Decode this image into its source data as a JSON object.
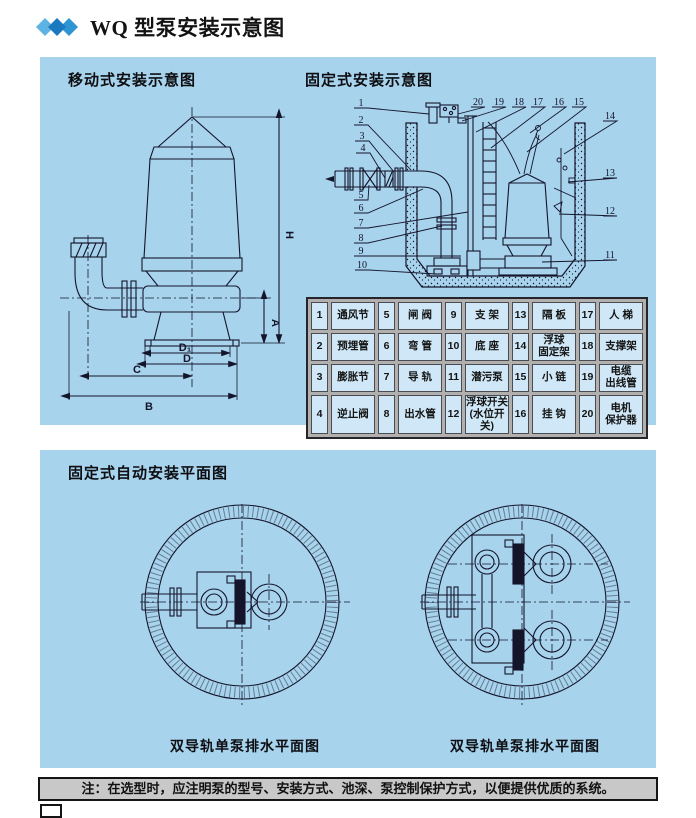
{
  "header": {
    "title": "WQ 型泵安装示意图"
  },
  "top_panel": {
    "left_title": "移动式安装示意图",
    "right_title": "固定式安装示意图"
  },
  "mobile_diagram": {
    "labels": {
      "h": "H",
      "a": "A",
      "d1": "D₁",
      "d": "D",
      "c": "C",
      "b": "B"
    }
  },
  "fixed_diagram": {
    "callouts_left": [
      "1",
      "2",
      "3",
      "4",
      "5",
      "6",
      "7",
      "8",
      "9",
      "10"
    ],
    "callouts_top": [
      "20",
      "19",
      "18",
      "17",
      "16",
      "15"
    ],
    "callouts_right": [
      "14",
      "13",
      "12",
      "11"
    ]
  },
  "parts_table": {
    "rows": [
      [
        {
          "num": "1",
          "name": "通风节"
        },
        {
          "num": "5",
          "name": "闸 阀"
        },
        {
          "num": "9",
          "name": "支 架"
        },
        {
          "num": "13",
          "name": "隔 板"
        },
        {
          "num": "17",
          "name": "人 梯"
        }
      ],
      [
        {
          "num": "2",
          "name": "预埋管"
        },
        {
          "num": "6",
          "name": "弯 管"
        },
        {
          "num": "10",
          "name": "底 座"
        },
        {
          "num": "14",
          "name": "浮球\n固定架"
        },
        {
          "num": "18",
          "name": "支撑架"
        }
      ],
      [
        {
          "num": "3",
          "name": "膨胀节"
        },
        {
          "num": "7",
          "name": "导 轨"
        },
        {
          "num": "11",
          "name": "潜污泵"
        },
        {
          "num": "15",
          "name": "小 链"
        },
        {
          "num": "19",
          "name": "电缆\n出线管"
        }
      ],
      [
        {
          "num": "4",
          "name": "逆止阀"
        },
        {
          "num": "8",
          "name": "出水管"
        },
        {
          "num": "12",
          "name": "浮球开关\n(水位开关)"
        },
        {
          "num": "16",
          "name": "挂 钩"
        },
        {
          "num": "20",
          "name": "电机\n保护器"
        }
      ]
    ]
  },
  "bottom_panel": {
    "title": "固定式自动安装平面图",
    "left_caption": "双导轨单泵排水平面图",
    "right_caption": "双导轨单泵排水平面图"
  },
  "note": "注：在选型时，应注明泵的型号、安装方式、池深、泵控制保护方式，以便提供优质的系统。",
  "colors": {
    "panel_bg": "#a7d3ec",
    "table_cell_bg": "#cfe7f6",
    "table_gutter": "#b2b0ae",
    "note_bg": "#c8c8c8",
    "line": "#14142b",
    "diamond_light": "#5cb3e4",
    "diamond_dark": "#1b79c0",
    "diamond_mid": "#2f95d2"
  }
}
